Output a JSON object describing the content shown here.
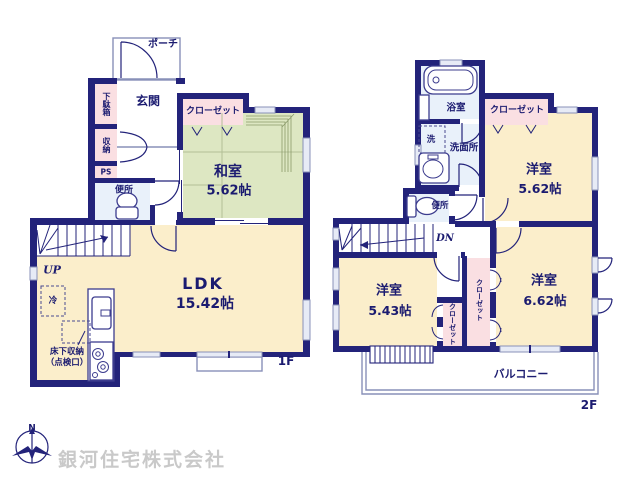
{
  "floor1": {
    "floor_label": "1F",
    "porch": "ポーチ",
    "entrance": "玄関",
    "shoe_cabinet": "下駄箱",
    "storage": "収納",
    "pipe_shaft": "PS",
    "toilet": "便所",
    "closet": "クローゼット",
    "japanese_room": {
      "name": "和室",
      "size": "5.62帖"
    },
    "ldk": {
      "name": "LDK",
      "size": "15.42帖"
    },
    "stairs": "UP",
    "refrigerator": "冷",
    "underfloor_storage": "床下収納",
    "inspection_hatch": "（点検口）"
  },
  "floor2": {
    "floor_label": "2F",
    "bathroom": "浴室",
    "washer": "洗",
    "washroom": "洗面所",
    "closet_north": "クローゼット",
    "western_room_ne": {
      "name": "洋室",
      "size": "5.62帖"
    },
    "toilet": "便所",
    "stairs": "DN",
    "western_room_sw": {
      "name": "洋室",
      "size": "5.43帖"
    },
    "closet_west": "クローゼット",
    "closet_east": "クローゼット",
    "western_room_se": {
      "name": "洋室",
      "size": "6.62帖"
    },
    "balcony": "バルコニー"
  },
  "compass": {
    "north": "N"
  },
  "watermark": "銀河住宅株式会社",
  "colors": {
    "wall": "#23237a",
    "tatami": "#dde7c2",
    "wood_floor": "#fbeecb",
    "closet_pink": "#fadfe2",
    "wet_area_blue": "#e9f1fa",
    "thin_outline": "#8890b8",
    "watermark_gray": "#c9c9c9",
    "text_navy": "#1b1b70"
  }
}
